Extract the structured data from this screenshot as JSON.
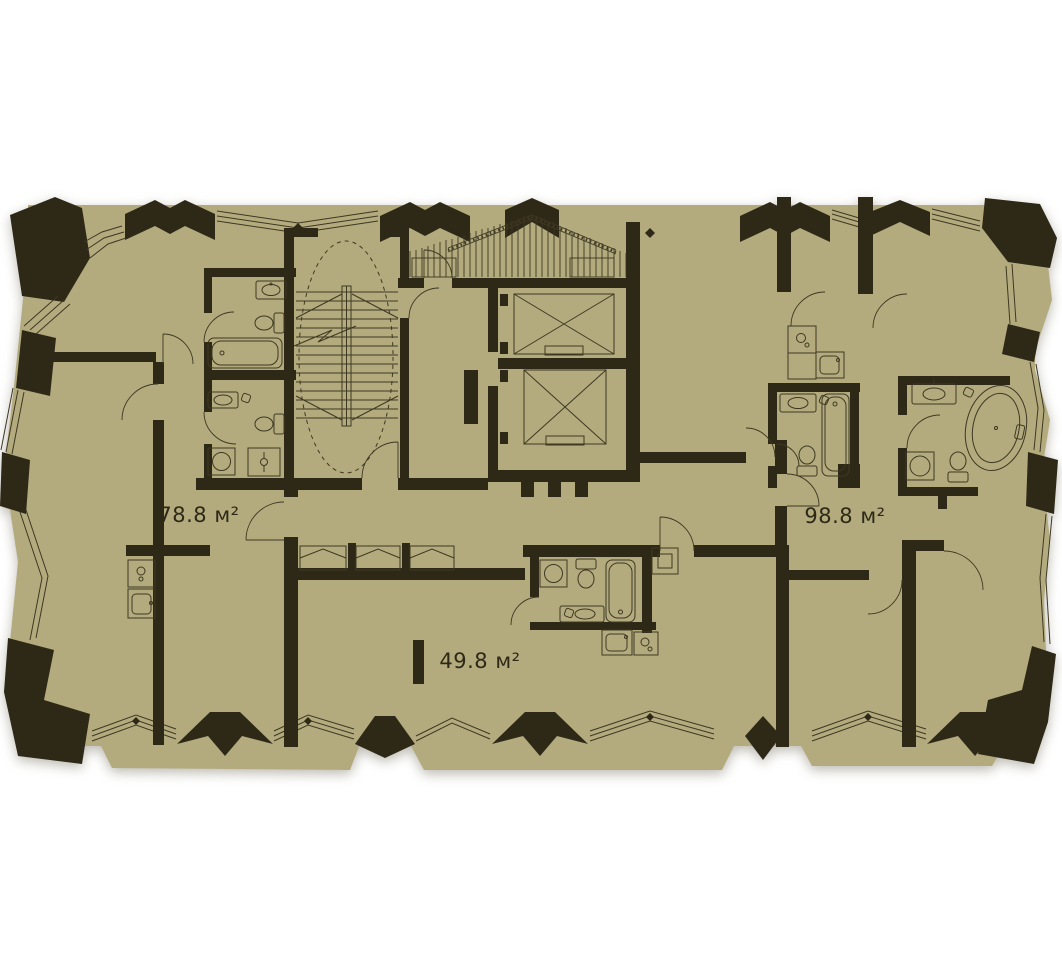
{
  "plan": {
    "type": "residential-floor-plan",
    "background": "#ffffff",
    "colors": {
      "floor": "#b3ab7e",
      "wall": "#2e2817",
      "line": "#3e3822",
      "text": "#2e2817"
    },
    "apartments": [
      {
        "id": "apartment-1",
        "area_label": "78.8 м²"
      },
      {
        "id": "apartment-2",
        "area_label": "98.8 м²"
      },
      {
        "id": "apartment-3",
        "area_label": "49.8 м²"
      }
    ]
  }
}
